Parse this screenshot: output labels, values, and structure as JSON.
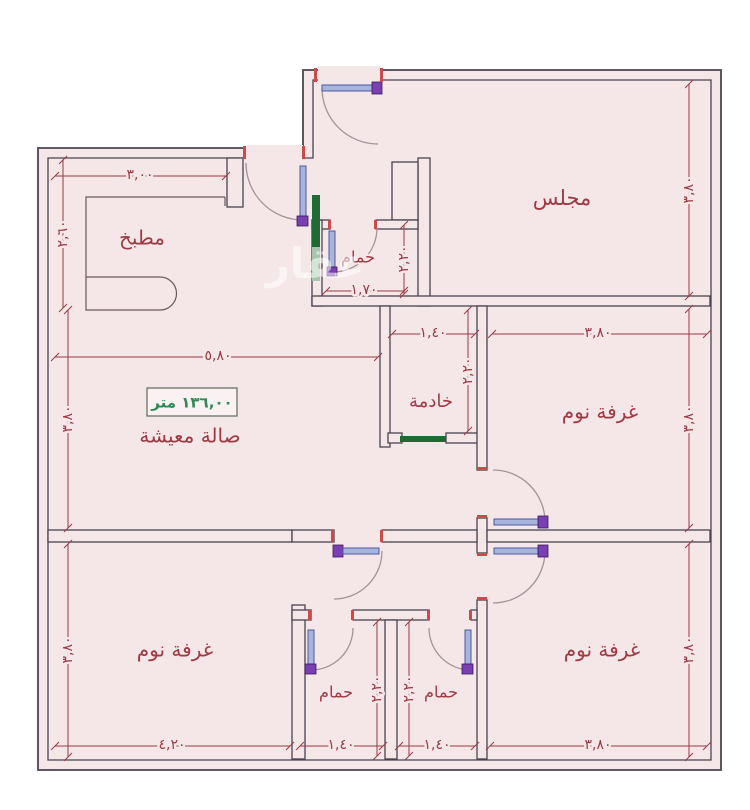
{
  "floor_plan": {
    "watermark": "عقار",
    "area_label": "١٣٦,٠٠ متر",
    "rooms": [
      {
        "id": "kitchen",
        "label": "مطبخ",
        "x": 142,
        "y": 239,
        "size": 20
      },
      {
        "id": "majlis",
        "label": "مجلس",
        "x": 562,
        "y": 199,
        "size": 21
      },
      {
        "id": "bathroom-top",
        "label": "حمام",
        "x": 358,
        "y": 258,
        "size": 16
      },
      {
        "id": "maid-room",
        "label": "خادمة",
        "x": 431,
        "y": 402,
        "size": 18
      },
      {
        "id": "living-hall",
        "label": "صالة معيشة",
        "x": 190,
        "y": 437,
        "size": 20
      },
      {
        "id": "bedroom-right",
        "label": "غرفة نوم",
        "x": 600,
        "y": 413,
        "size": 20
      },
      {
        "id": "bedroom-bottom-left",
        "label": "غرفة نوم",
        "x": 175,
        "y": 651,
        "size": 20
      },
      {
        "id": "bedroom-bottom-right",
        "label": "غرفة نوم",
        "x": 602,
        "y": 651,
        "size": 20
      },
      {
        "id": "bathroom-a",
        "label": "حمام",
        "x": 336,
        "y": 693,
        "size": 16
      },
      {
        "id": "bathroom-b",
        "label": "حمام",
        "x": 441,
        "y": 693,
        "size": 16
      }
    ],
    "dimensions": [
      {
        "label": "٣,٠٠",
        "x1": 55,
        "y1": 176,
        "x2": 226,
        "y2": 176,
        "lx": 140,
        "ly": 175,
        "rot": 0
      },
      {
        "label": "٢,٦٠",
        "x1": 63,
        "y1": 160,
        "x2": 63,
        "y2": 308,
        "lx": 63,
        "ly": 234,
        "rot": -90
      },
      {
        "label": "٥,٨٠",
        "x1": 55,
        "y1": 357,
        "x2": 378,
        "y2": 357,
        "lx": 218,
        "ly": 356,
        "rot": 0
      },
      {
        "label": "١,٧٠",
        "x1": 326,
        "y1": 291,
        "x2": 404,
        "y2": 291,
        "lx": 364,
        "ly": 290,
        "rot": 0
      },
      {
        "label": "٢,٢٠",
        "x1": 404,
        "y1": 225,
        "x2": 404,
        "y2": 294,
        "lx": 404,
        "ly": 259,
        "rot": -90
      },
      {
        "label": "٣,٨٠",
        "x1": 689,
        "y1": 84,
        "x2": 689,
        "y2": 296,
        "lx": 689,
        "ly": 190,
        "rot": -90
      },
      {
        "label": "٣,٨٠",
        "x1": 492,
        "y1": 334,
        "x2": 707,
        "y2": 334,
        "lx": 598,
        "ly": 333,
        "rot": 0
      },
      {
        "label": "١,٤٠",
        "x1": 392,
        "y1": 334,
        "x2": 475,
        "y2": 334,
        "lx": 433,
        "ly": 333,
        "rot": 0
      },
      {
        "label": "٢,٢٠",
        "x1": 468,
        "y1": 310,
        "x2": 468,
        "y2": 431,
        "lx": 468,
        "ly": 371,
        "rot": -90
      },
      {
        "label": "٣,٨٠",
        "x1": 689,
        "y1": 309,
        "x2": 689,
        "y2": 528,
        "lx": 689,
        "ly": 419,
        "rot": -90
      },
      {
        "label": "٣,٨٠",
        "x1": 68,
        "y1": 310,
        "x2": 68,
        "y2": 528,
        "lx": 68,
        "ly": 419,
        "rot": -90
      },
      {
        "label": "٣,٨٠",
        "x1": 68,
        "y1": 544,
        "x2": 68,
        "y2": 757,
        "lx": 68,
        "ly": 650,
        "rot": -90
      },
      {
        "label": "٤,٢٠",
        "x1": 55,
        "y1": 746,
        "x2": 290,
        "y2": 746,
        "lx": 172,
        "ly": 745,
        "rot": 0
      },
      {
        "label": "١,٤٠",
        "x1": 300,
        "y1": 746,
        "x2": 383,
        "y2": 746,
        "lx": 341,
        "ly": 745,
        "rot": 0
      },
      {
        "label": "١,٤٠",
        "x1": 399,
        "y1": 746,
        "x2": 475,
        "y2": 746,
        "lx": 437,
        "ly": 745,
        "rot": 0
      },
      {
        "label": "٣,٨٠",
        "x1": 490,
        "y1": 746,
        "x2": 707,
        "y2": 746,
        "lx": 598,
        "ly": 745,
        "rot": 0
      },
      {
        "label": "٢,٢٠",
        "x1": 377,
        "y1": 622,
        "x2": 377,
        "y2": 756,
        "lx": 377,
        "ly": 689,
        "rot": -90
      },
      {
        "label": "٢,٢٠",
        "x1": 409,
        "y1": 622,
        "x2": 409,
        "y2": 756,
        "lx": 409,
        "ly": 689,
        "rot": -90
      },
      {
        "label": "٣,٨٠",
        "x1": 689,
        "y1": 544,
        "x2": 689,
        "y2": 757,
        "lx": 689,
        "ly": 650,
        "rot": -90
      }
    ],
    "colors": {
      "background": "#ffffff",
      "floor": "#f5e6e8",
      "wall": "#4b4450",
      "dimension_text": "#993b44",
      "room_text": "#9e3a44",
      "area_text": "#2f8a57",
      "door_leaf_blue": "#a9b4dd",
      "door_hinge_purple": "#7a3fb0",
      "sill_green": "#1e6b35",
      "jamb_red": "#cc4a4a"
    }
  }
}
